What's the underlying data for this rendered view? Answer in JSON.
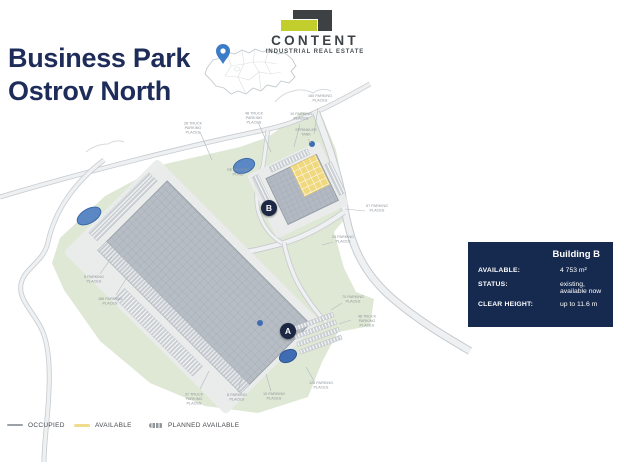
{
  "header": {
    "title_line1": "Business Park",
    "title_line2": "Ostrov North"
  },
  "logo": {
    "brand": "CONTENT",
    "tagline": "INDUSTRIAL REAL ESTATE"
  },
  "location_map": {
    "pin_icon": "location-pin-icon"
  },
  "site_plan": {
    "building_a_marker": "A",
    "building_b_marker": "B",
    "labels": [
      "28 TRUCK PARKING PLACES",
      "48 TRUCK PARKING PLACES",
      "10 PARKING PLACES",
      "160 PARKING PLACES",
      "SPRINKLER TANK",
      "RETENTION POND",
      "57 PARKING PLACES",
      "24 PARKING PLACES",
      "70 PARKING PLACES",
      "48 TRUCK PARKING PLACES",
      "128 PARKING PLACES",
      "10 PARKING PLACES",
      "8 PARKING PLACES",
      "37 TRUCK PARKING PLACES",
      "185 PARKING PLACES",
      "8 PARKING PLACES"
    ]
  },
  "info_panel": {
    "title": "Building B",
    "rows": [
      {
        "label": "AVAILABLE:",
        "value": "4 753 m²"
      },
      {
        "label": "STATUS:",
        "value": "existing, available now"
      },
      {
        "label": "CLEAR HEIGHT:",
        "value": "up to 11.6 m"
      }
    ]
  },
  "legend": {
    "items": [
      {
        "label": "OCCUPIED"
      },
      {
        "label": "AVAILABLE"
      },
      {
        "label": "PLANNED AVAILABLE"
      }
    ]
  },
  "colors": {
    "title_navy": "#1e2c5a",
    "panel_navy": "#16294f",
    "logo_lime": "#c2ce2b",
    "logo_dark": "#3d4144",
    "available_yellow": "#f0d87e",
    "occupied_gray": "#b7bdc5",
    "site_green": "#dfe8d5",
    "pond_blue": "#4f7fbe",
    "pin_blue": "#3b7cc9"
  }
}
